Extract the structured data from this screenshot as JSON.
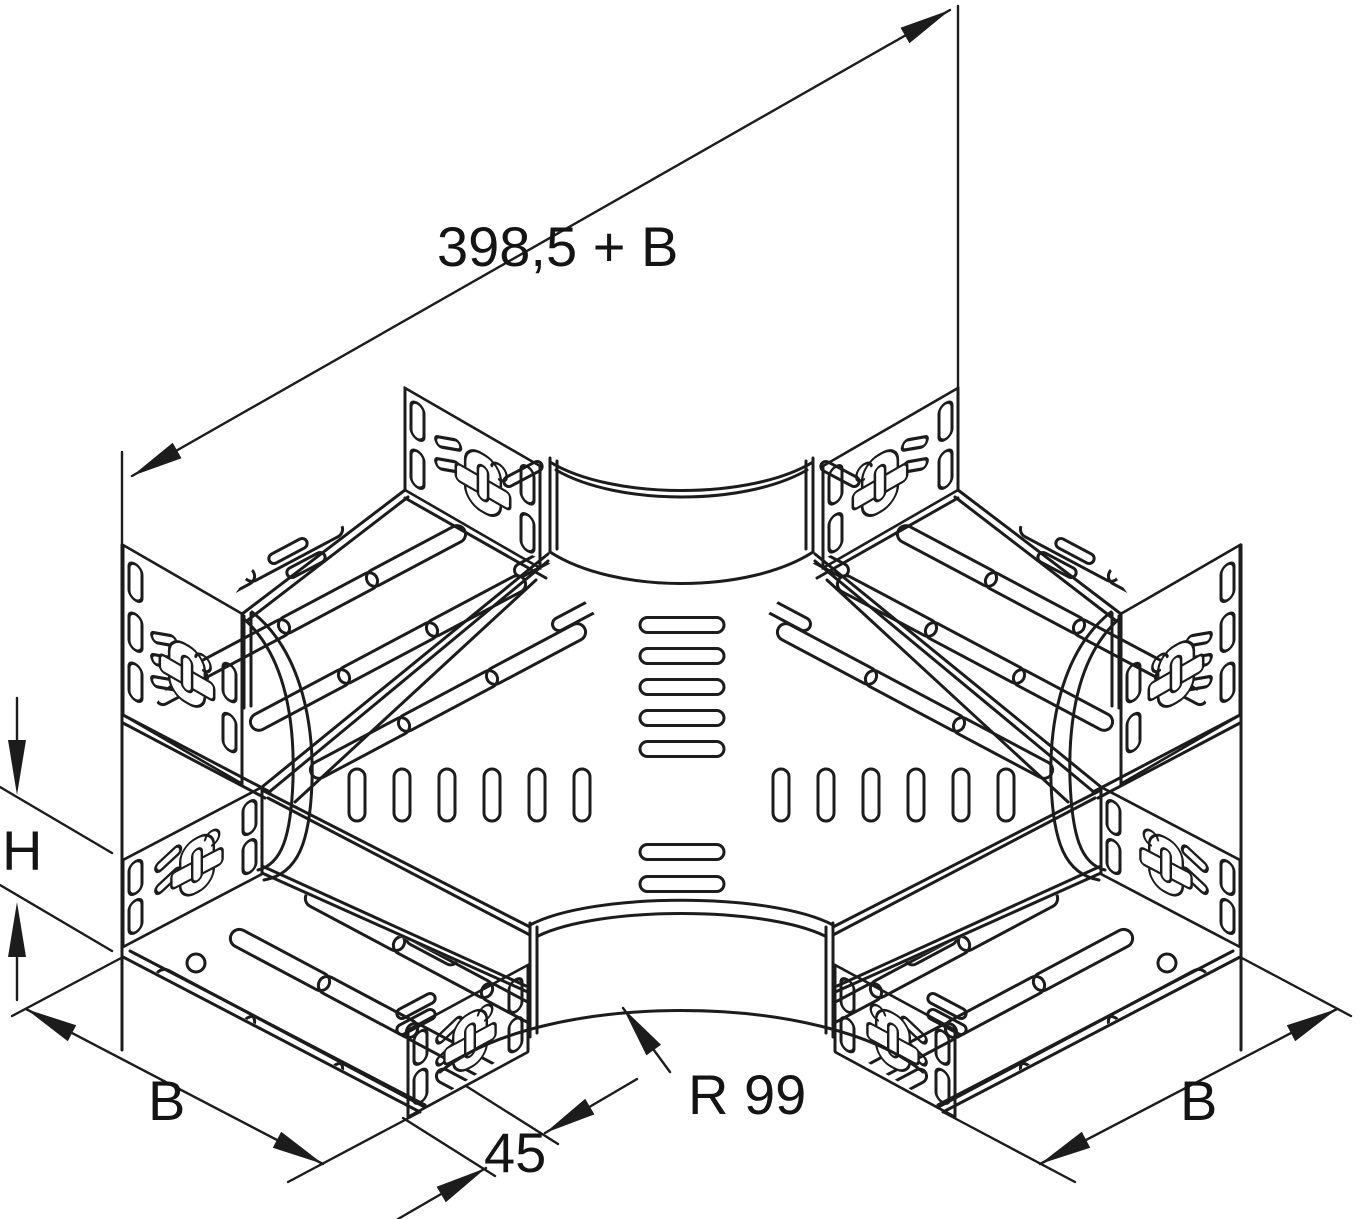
{
  "page": {
    "background": "#ffffff"
  },
  "drawing": {
    "type": "technical-line-drawing",
    "subject": "cable tray 4-way cross piece (X-piece), isometric view",
    "stroke_color": "#1c1c1c",
    "labels": {
      "length_top": "398,5 + B",
      "height_left": "H",
      "width_bottom_left": "B",
      "straight_offset": "45",
      "radius": "R 99",
      "width_bottom_right": "B"
    }
  }
}
